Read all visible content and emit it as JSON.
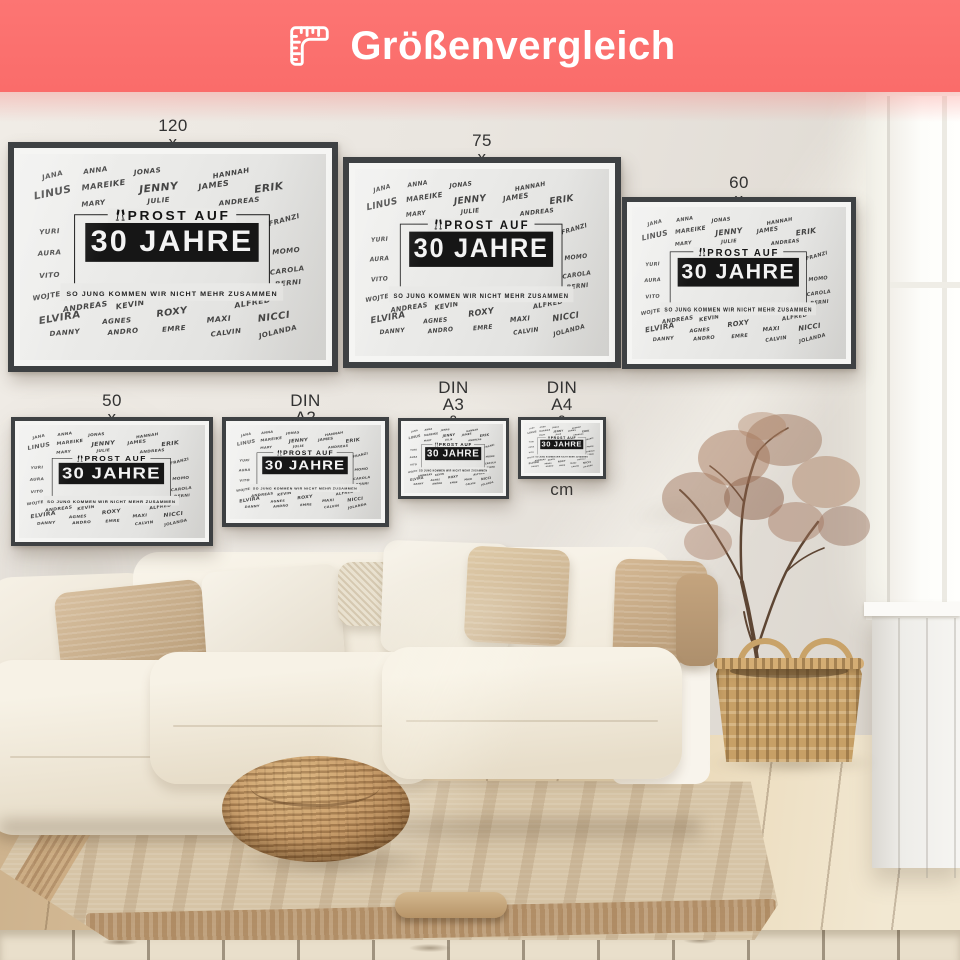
{
  "header": {
    "title": "Größenvergleich",
    "icon": "ruler-corner-icon",
    "bg_color": "#fb6f6d",
    "text_color": "#ffffff"
  },
  "posters": [
    {
      "label": "120 x 80 cm & DIN A0",
      "x": 8,
      "y": 50,
      "w": 330,
      "h": 230,
      "frame": 6,
      "mat": 6,
      "label_top": 25
    },
    {
      "label": "75 x 100 cm",
      "x": 343,
      "y": 65,
      "w": 278,
      "h": 211,
      "frame": 6,
      "mat": 6,
      "label_top": 40
    },
    {
      "label": "60 x 80 cm & DIN A1",
      "x": 622,
      "y": 105,
      "w": 234,
      "h": 172,
      "frame": 5,
      "mat": 5,
      "label_top": 82
    },
    {
      "label": "50 x 75 cm",
      "x": 11,
      "y": 325,
      "w": 202,
      "h": 129,
      "frame": 4,
      "mat": 4,
      "label_top": 300
    },
    {
      "label": "DIN A2 & 40 x 60 cm",
      "x": 222,
      "y": 325,
      "w": 167,
      "h": 110,
      "frame": 4,
      "mat": 4,
      "label_top": 300
    },
    {
      "label": "DIN A3 &\n30 x 40 cm",
      "x": 398,
      "y": 326,
      "w": 111,
      "h": 81,
      "frame": 3,
      "mat": 3,
      "label_top": 287
    },
    {
      "label": "DIN A4 &\n20 x 30 cm",
      "x": 518,
      "y": 325,
      "w": 88,
      "h": 62,
      "frame": 3,
      "mat": 3,
      "label_top": 287
    }
  ],
  "poster_design": {
    "heading": "PROST AUF",
    "title": "30 JAHRE",
    "subtitle": "SO JUNG KOMMEN WIR NICHT MEHR ZUSAMMEN",
    "icon": "champagne-glasses-icon",
    "names": [
      {
        "t": "JANA",
        "x": 10.5,
        "y": 10.5,
        "r": -14,
        "s": 1
      },
      {
        "t": "ANNA",
        "x": 24.6,
        "y": 8.1,
        "r": -8,
        "s": 1
      },
      {
        "t": "JONAS",
        "x": 41.6,
        "y": 8.6,
        "r": -6,
        "s": 1
      },
      {
        "t": "HANNAH",
        "x": 68.9,
        "y": 9.6,
        "r": -10,
        "s": 1
      },
      {
        "t": "LINUS",
        "x": 10.5,
        "y": 18.7,
        "r": -12,
        "s": 1.5
      },
      {
        "t": "MAREIKE",
        "x": 27.2,
        "y": 15.3,
        "r": -8,
        "s": 1.15
      },
      {
        "t": "JENNY",
        "x": 45.2,
        "y": 16.3,
        "r": -6,
        "s": 1.5
      },
      {
        "t": "JAMES",
        "x": 63.3,
        "y": 15.3,
        "r": -8,
        "s": 1.15
      },
      {
        "t": "ERIK",
        "x": 81.3,
        "y": 16.3,
        "r": -8,
        "s": 1.5
      },
      {
        "t": "MARY",
        "x": 23.9,
        "y": 23.9,
        "r": -6,
        "s": 1
      },
      {
        "t": "JULIE",
        "x": 45.2,
        "y": 22.5,
        "r": -5,
        "s": 1
      },
      {
        "t": "ANDREAS",
        "x": 71.5,
        "y": 23.0,
        "r": -6,
        "s": 1
      },
      {
        "t": "FRANZI",
        "x": 86.2,
        "y": 32.1,
        "r": -16,
        "s": 1
      },
      {
        "t": "YURI",
        "x": 9.8,
        "y": 37.8,
        "r": -4,
        "s": 1
      },
      {
        "t": "AURA",
        "x": 9.8,
        "y": 48.3,
        "r": -4,
        "s": 1
      },
      {
        "t": "MOMO",
        "x": 86.9,
        "y": 47.4,
        "r": -6,
        "s": 1
      },
      {
        "t": "VITO",
        "x": 9.8,
        "y": 58.9,
        "r": -4,
        "s": 1
      },
      {
        "t": "CAROLA",
        "x": 87.2,
        "y": 56.5,
        "r": -8,
        "s": 1
      },
      {
        "t": "BERNI",
        "x": 87.5,
        "y": 62.7,
        "r": -6,
        "s": 1
      },
      {
        "t": "WOJTEK",
        "x": 9.5,
        "y": 68.9,
        "r": -10,
        "s": 1
      },
      {
        "t": "ANDREAS",
        "x": 21.3,
        "y": 74.2,
        "r": -8,
        "s": 1.1
      },
      {
        "t": "KEVIN",
        "x": 36.1,
        "y": 73.2,
        "r": -10,
        "s": 1.1
      },
      {
        "t": "ALFRED",
        "x": 76.1,
        "y": 72.2,
        "r": -10,
        "s": 1.1
      },
      {
        "t": "ELVIRA",
        "x": 13.1,
        "y": 79.9,
        "r": -10,
        "s": 1.45
      },
      {
        "t": "AGNES",
        "x": 31.8,
        "y": 80.9,
        "r": -4,
        "s": 1
      },
      {
        "t": "ROXY",
        "x": 49.8,
        "y": 77.0,
        "r": -8,
        "s": 1.35
      },
      {
        "t": "MAXI",
        "x": 64.9,
        "y": 80.4,
        "r": -5,
        "s": 1.1
      },
      {
        "t": "NICCI",
        "x": 83.0,
        "y": 79.4,
        "r": -8,
        "s": 1.4
      },
      {
        "t": "DANNY",
        "x": 14.8,
        "y": 86.6,
        "r": -5,
        "s": 1
      },
      {
        "t": "ANDRO",
        "x": 33.8,
        "y": 86.1,
        "r": -5,
        "s": 1
      },
      {
        "t": "EMRE",
        "x": 50.2,
        "y": 84.7,
        "r": -5,
        "s": 1
      },
      {
        "t": "CALVIN",
        "x": 67.2,
        "y": 86.6,
        "r": -8,
        "s": 1
      },
      {
        "t": "JOLANDA",
        "x": 84.3,
        "y": 86.1,
        "r": -14,
        "s": 1
      }
    ]
  }
}
